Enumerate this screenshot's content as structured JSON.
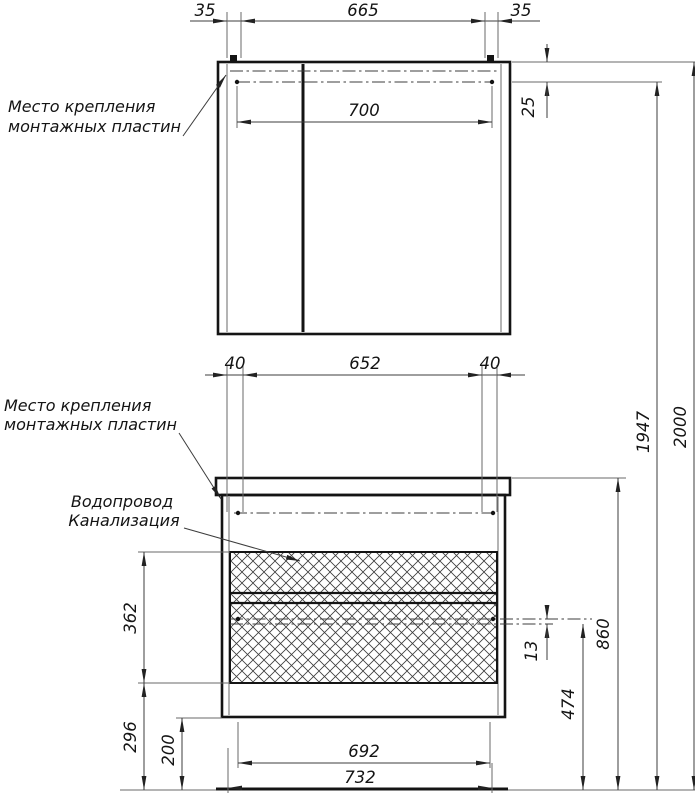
{
  "labels": {
    "mounting_plates_line1": "Место крепления",
    "mounting_plates_line2": "монтажных пластин",
    "plumbing_line1": "Водопровод",
    "plumbing_line2": "Канализация"
  },
  "dimensions": {
    "mirror": {
      "offset_left": "35",
      "plate_spacing": "665",
      "offset_right": "35",
      "inner_width": "700",
      "top_offset": "25"
    },
    "cabinet": {
      "offset_left": "40",
      "plate_spacing": "652",
      "offset_right": "40",
      "rail_gap": "13",
      "drawer_zone_height": "362",
      "bottom_zone_height": "296",
      "leg_clearance": "200",
      "drawer_width": "692",
      "overall_width": "732"
    },
    "heights": {
      "rail": "474",
      "countertop": "860",
      "mirror_plates": "1947",
      "overall": "2000"
    }
  }
}
